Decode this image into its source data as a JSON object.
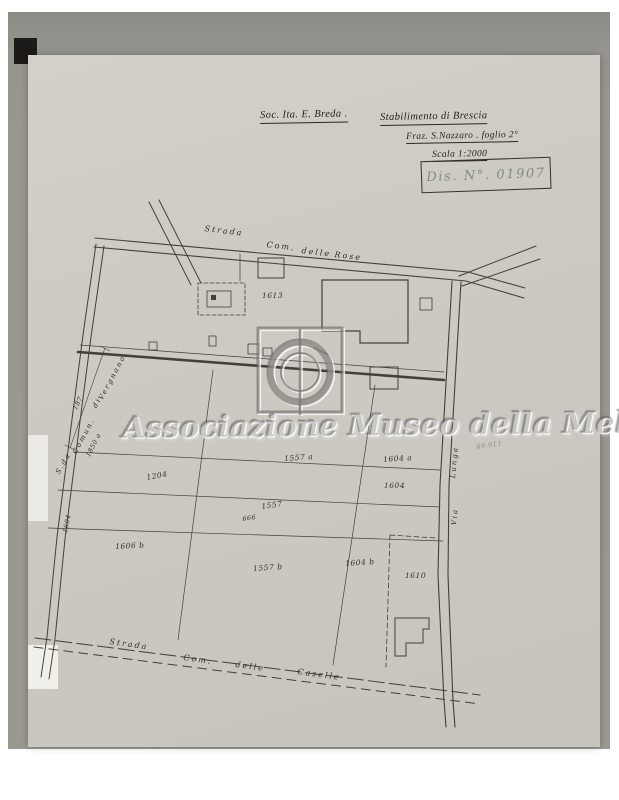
{
  "header": {
    "company": "Soc. Ita. E. Breda .",
    "plant": "Stabilimento di Brescia",
    "fraction": "Fraz. S.Nazzaro . foglio 2°",
    "scale": "Scala 1:2000",
    "drawing_no": "Dis. N°. 01907"
  },
  "roads": {
    "top": [
      "Strada",
      "Com.",
      "delle",
      "Rose"
    ],
    "bottom": [
      "Strada",
      "Com.",
      "delle",
      "Caselle"
    ],
    "left": [
      "S.da",
      "Comun.",
      "di",
      "Vergnano"
    ],
    "right": [
      "Via",
      "Lunga"
    ]
  },
  "parcels": {
    "p1613": "1613",
    "p1557a": "1557 a",
    "p1604a": "1604 a",
    "p1604": "1604",
    "p1204": "1204",
    "p1557": "1557",
    "p666": "666",
    "p1606b": "1606 b",
    "p1557b": "1557 b",
    "p1604b": "1604 b",
    "p1610": "1610",
    "p1604v": "1604",
    "p1850a": "1850 a",
    "d187": "187",
    "pencil": "69.911"
  },
  "watermark": {
    "text": "Associazione Museo della Melara"
  },
  "colors": {
    "paper": "#ccc9c2",
    "photo_background": "#98958f",
    "ink": "#33312b",
    "stamp_ink": "#75806f",
    "watermark_gray": "#7d7a73"
  }
}
